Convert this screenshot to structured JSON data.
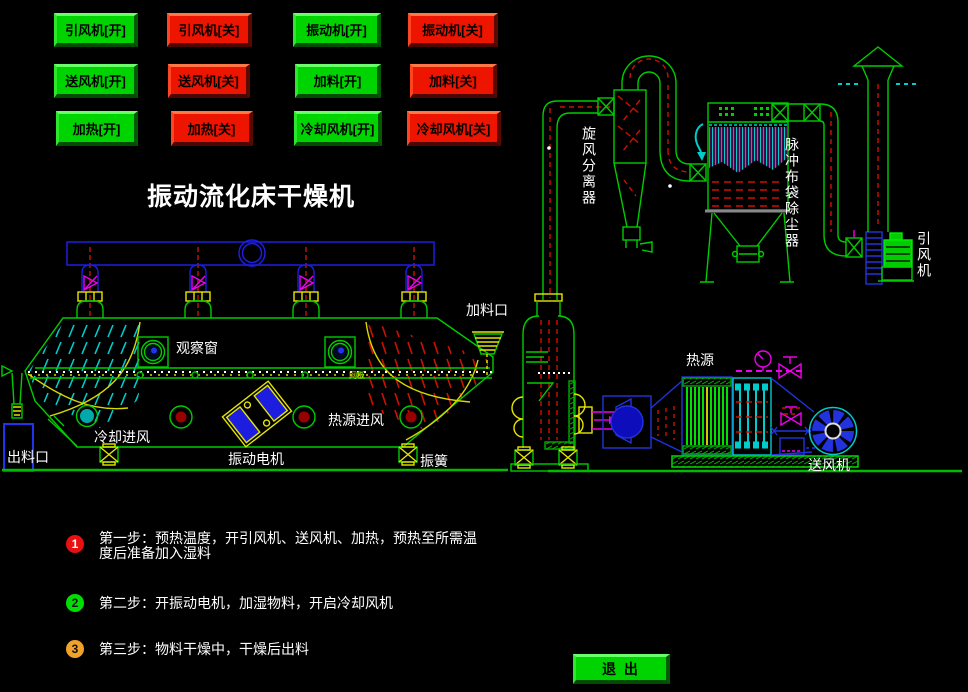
{
  "title": "振动流化床干燥机",
  "buttons": {
    "grid": [
      {
        "label": "引风机[开]",
        "state": "on"
      },
      {
        "label": "引风机[关]",
        "state": "off"
      },
      {
        "label": "振动机[开]",
        "state": "on"
      },
      {
        "label": "振动机[关]",
        "state": "off"
      },
      {
        "label": "送风机[开]",
        "state": "on"
      },
      {
        "label": "送风机[关]",
        "state": "off"
      },
      {
        "label": "加料[开]",
        "state": "on"
      },
      {
        "label": "加料[关]",
        "state": "off"
      },
      {
        "label": "加热[开]",
        "state": "on"
      },
      {
        "label": "加热[关]",
        "state": "off"
      },
      {
        "label": "冷却风机[开]",
        "state": "on"
      },
      {
        "label": "冷却风机[关]",
        "state": "off"
      }
    ],
    "exit": "退 出"
  },
  "diagram": {
    "labels": {
      "feed_port": "加料口",
      "observation_window": "观察窗",
      "mesh_plate": "网板",
      "heat_source": "热源",
      "hot_air_inlet": "热源进风",
      "cooling_air_inlet": "冷却进风",
      "discharge_port": "出料口",
      "vibration_motor": "振动电机",
      "vibration_spring": "振簧",
      "supply_fan": "送风机",
      "cyclone_separator": "旋风分离器",
      "pulse_bag_filter": "脉冲布袋除尘器",
      "induced_draft_fan": "引风机"
    }
  },
  "steps": [
    {
      "num": "1",
      "badge_color": "#e81010",
      "text": "第一步：预热温度，开引风机、送风机、加热，预热至所需温度后准备加入湿料"
    },
    {
      "num": "2",
      "badge_color": "#00dd00",
      "text": "第二步：开振动电机，加湿物料，开启冷却风机"
    },
    {
      "num": "3",
      "badge_color": "#f0a22a",
      "text": "第三步：物料干燥中，干燥后出料"
    }
  ],
  "colors": {
    "background": "#000000",
    "on_button": "#00d400",
    "off_button": "#ee1500",
    "line_green": "#00cc00",
    "line_blue": "#2222dd",
    "line_cyan": "#00cccc",
    "line_red": "#cc1100",
    "line_magenta": "#ee00ee",
    "line_yellow": "#e6e600",
    "label_text": "#ffffff"
  }
}
